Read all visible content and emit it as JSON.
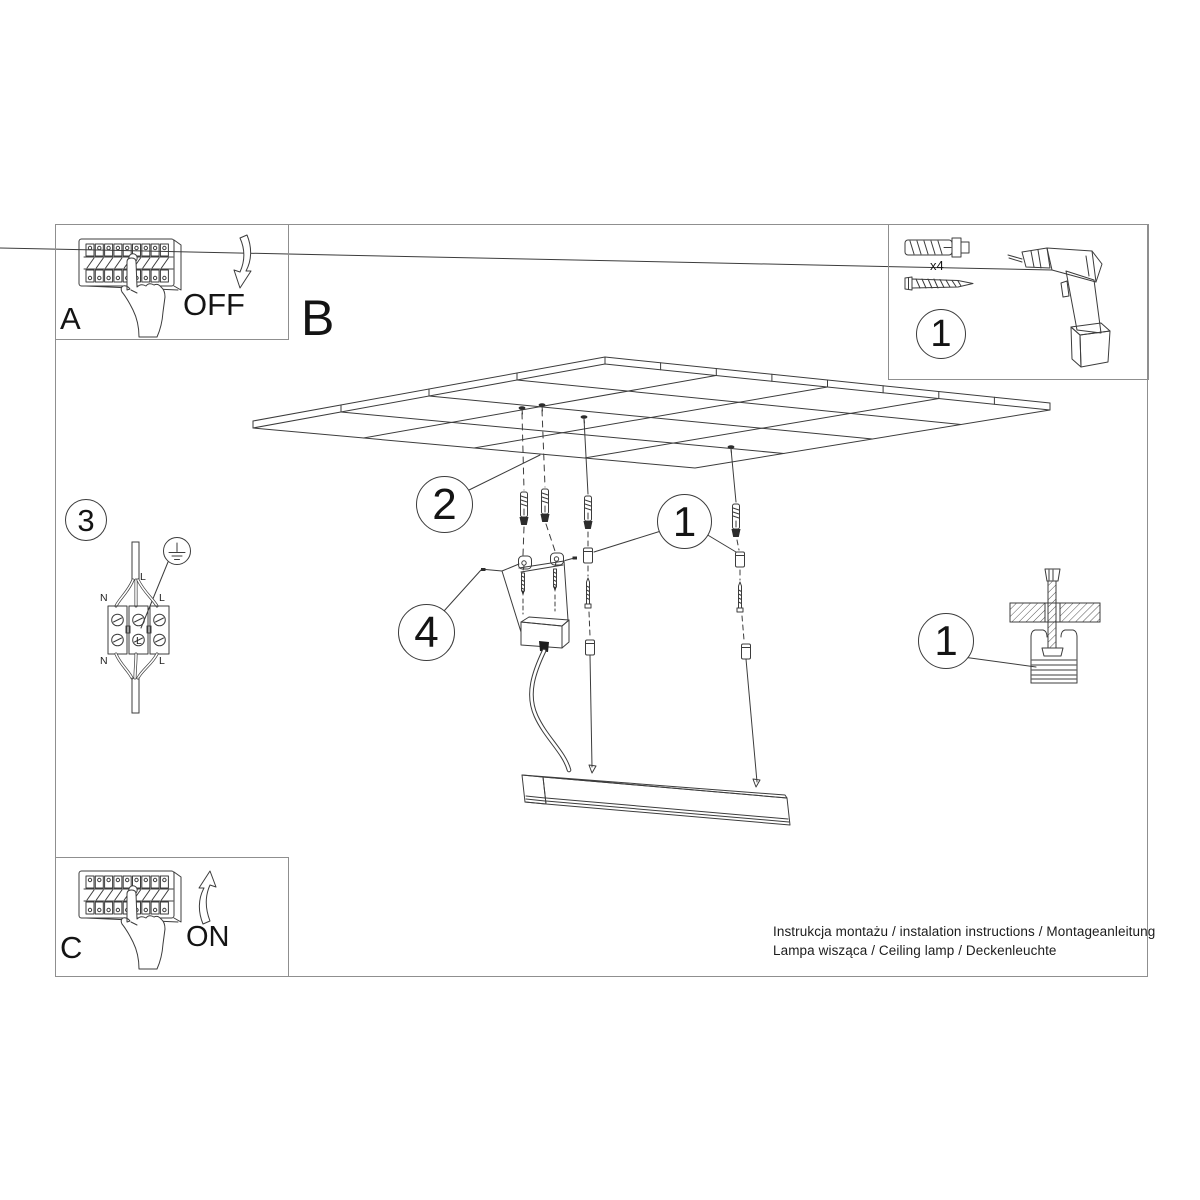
{
  "colors": {
    "background": "#ffffff",
    "line": "#3c3c3c",
    "frame": "#8f8f8f",
    "text": "#141414"
  },
  "sections": {
    "a": "A",
    "b": "B",
    "c": "C"
  },
  "breaker": {
    "off": "OFF",
    "on": "ON"
  },
  "callouts": {
    "tools_step": "1",
    "ceiling_step": "2",
    "suspension_step": "1",
    "wiring_step": "3",
    "canopy_step": "4",
    "anchor_detail_step": "1"
  },
  "tools": {
    "anchor_qty": "x4"
  },
  "wiring": {
    "top_l": "L",
    "left_n": "N",
    "right_l": "L",
    "inner_l": "L",
    "bottom_n": "N",
    "bottom_l": "L"
  },
  "footer": {
    "line1": "Instrukcja montażu / instalation instructions / Montageanleitung",
    "line2": "Lampa wisząca / Ceiling lamp / Deckenleuchte"
  }
}
